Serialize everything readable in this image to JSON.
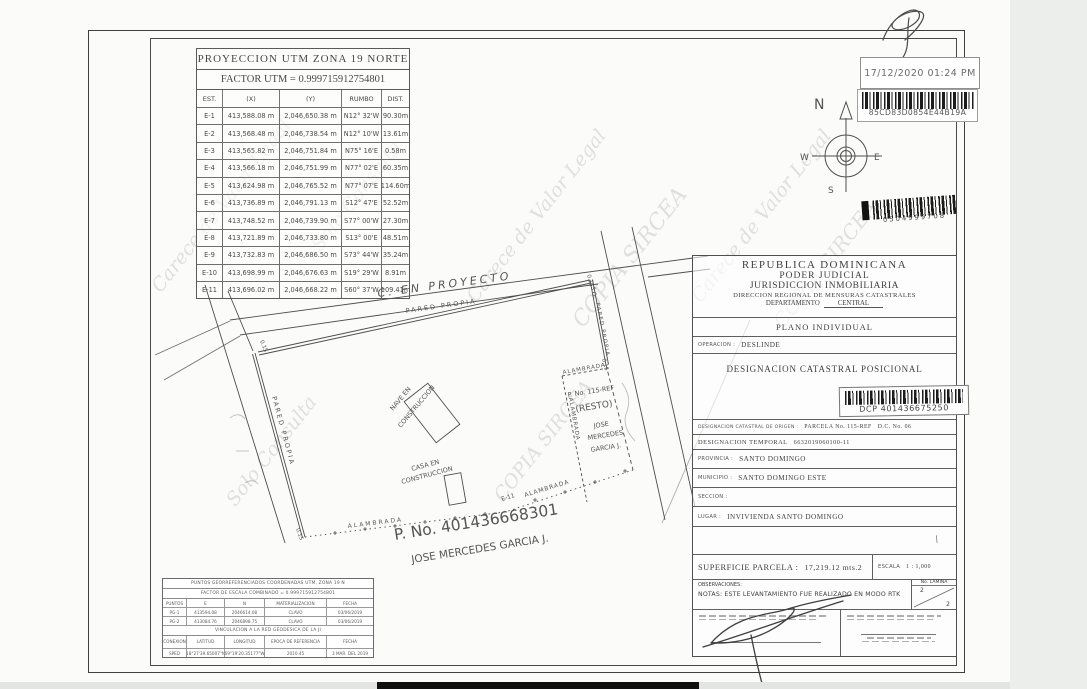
{
  "watermark": {
    "t1": "Carece de Valor Legal",
    "t2": "Solo Consulta",
    "t3": "COPIA SIRCEA"
  },
  "stamps": {
    "timestamp": "17/12/2020 01:24 PM",
    "barcode1_text": "85CD83D0854E44B19A",
    "barcode2_text": "0504999708"
  },
  "compass": {
    "n": "N",
    "w": "W",
    "e": "E",
    "s": "S"
  },
  "utm_table": {
    "title": "PROYECCION UTM ZONA 19 NORTE",
    "factor": "FACTOR UTM =  0.999715912754801",
    "headers": [
      "EST.",
      "(X)",
      "(Y)",
      "RUMBO",
      "DIST."
    ],
    "rows": [
      [
        "E-1",
        "413,588.08 m",
        "2,046,650.38 m",
        "N12° 32'W",
        "90.30m"
      ],
      [
        "E-2",
        "413,568.48 m",
        "2,046,738.54 m",
        "N12° 10'W",
        "13.61m"
      ],
      [
        "E-3",
        "413,565.82 m",
        "2,046,751.84 m",
        "N75° 16'E",
        "0.58m"
      ],
      [
        "E-4",
        "413,566.18 m",
        "2,046,751.99 m",
        "N77° 02'E",
        "60.35m"
      ],
      [
        "E-5",
        "413,624.98 m",
        "2,046,765.52 m",
        "N77° 07'E",
        "114.60m"
      ],
      [
        "E-6",
        "413,736.89 m",
        "2,046,791.13 m",
        "S12° 47'E",
        "52.52m"
      ],
      [
        "E-7",
        "413,748.52 m",
        "2,046,739.90 m",
        "S77° 00'W",
        "27.30m"
      ],
      [
        "E-8",
        "413,721.89 m",
        "2,046,733.80 m",
        "S13° 00'E",
        "48.51m"
      ],
      [
        "E-9",
        "413,732.83 m",
        "2,046,686.50 m",
        "S73° 44'W",
        "35.24m"
      ],
      [
        "E-10",
        "413,698.99 m",
        "2,046,676.63 m",
        "S19° 29'W",
        "8.91m"
      ],
      [
        "E-11",
        "413,696.02 m",
        "2,046,668.22 m",
        "S60° 37'W",
        "109.41m"
      ]
    ]
  },
  "plot": {
    "street_top": "C. EN PROYECTO",
    "pared_top": "PARED PROPIA",
    "pared_left": "PARED PROPIA",
    "so_right": "S.O.",
    "pared_right": "PARED PROPIA",
    "alambrada": "ALAMBRADA",
    "nave_line1": "NAVE EN",
    "nave_line2": "CONSTRUCCION",
    "casa_line1": "CASA EN",
    "casa_line2": "CONSTRUCCION",
    "resto_p": "P. No. 115-REF",
    "resto": "(RESTO)",
    "resto_owner1": "JOSE",
    "resto_owner2": "MERCEDES",
    "resto_owner3": "GARCIA J.",
    "parcel_p": "P. No. 401436668301",
    "owner": "JOSE MERCEDES GARCIA J.",
    "e11": "E-11",
    "dim": "0.15"
  },
  "info_panel": {
    "header_l1": "REPUBLICA DOMINICANA",
    "header_l2": "PODER JUDICIAL",
    "header_l3": "JURISDICCION INMOBILIARIA",
    "header_l4": "DIRECCION REGIONAL DE MENSURAS CATASTRALES",
    "departamento_label": "DEPARTAMENTO",
    "departamento_value": "CENTRAL",
    "plano": "PLANO INDIVIDUAL",
    "operacion_label": "OPERACION :",
    "operacion_value": "DESLINDE",
    "dcp_title": "DESIGNACION CATASTRAL POSICIONAL",
    "dcp_barcode": "DCP 401436675250",
    "origen_label": "DESIGNACION CATASTRAL DE ORIGEN :",
    "origen_value": "PARCELA No. 115-REF",
    "origen_dc": "D.C. No. 06",
    "temporal_label": "DESIGNACION TEMPORAL",
    "temporal_value": "6632019060100-11",
    "provincia_label": "PROVINCIA :",
    "provincia_value": "SANTO DOMINGO",
    "municipio_label": "MUNICIPIO :",
    "municipio_value": "SANTO DOMINGO ESTE",
    "seccion_label": "SECCION :",
    "seccion_value": "",
    "lugar_label": "LUGAR :",
    "lugar_value": "INVIVIENDA SANTO DOMINGO",
    "superficie_label": "SUPERFICIE PARCELA :",
    "superficie_value": "17,219.12 mts.2",
    "escala_label": "ESCALA",
    "escala_value": "1 : 1,000",
    "observaciones_label": "OBSERVACIONES:",
    "notas": "NOTAS: ESTE LEVANTAMIENTO FUE REALIZADO EN MODO RTK",
    "lamina_label": "No. LAMINA",
    "lamina_top": "2",
    "lamina_bottom": "2"
  },
  "geo_table": {
    "title": "PUNTOS GEORREFERENCIADOS COORDENADAS UTM, ZONA 19 N",
    "factor": "FACTOR DE ESCALA COMBINADO =   0.999715912754801",
    "headers": [
      "PUNTOS",
      "E",
      "N",
      "MATERIALIZACION",
      "FECHA"
    ],
    "rows": [
      [
        "PG-1",
        "413594.08",
        "2046614.08",
        "CLAVO",
        "03/06/2019"
      ],
      [
        "PG-2",
        "413084.76",
        "2046898.75",
        "CLAVO",
        "03/06/2019"
      ]
    ],
    "band": "VINCULACION A LA RED GEODESICA DE LA JI",
    "headers2": [
      "CONEXION",
      "LATITUD",
      "LONGITUD",
      "EPOCA DE REFERENCIA",
      "FECHA"
    ],
    "row2": [
      "SPED",
      "18°27'39.65007\"N",
      "69°19'20.35177\"W",
      "2010.45",
      "3 MAR. DEL 2019"
    ]
  }
}
